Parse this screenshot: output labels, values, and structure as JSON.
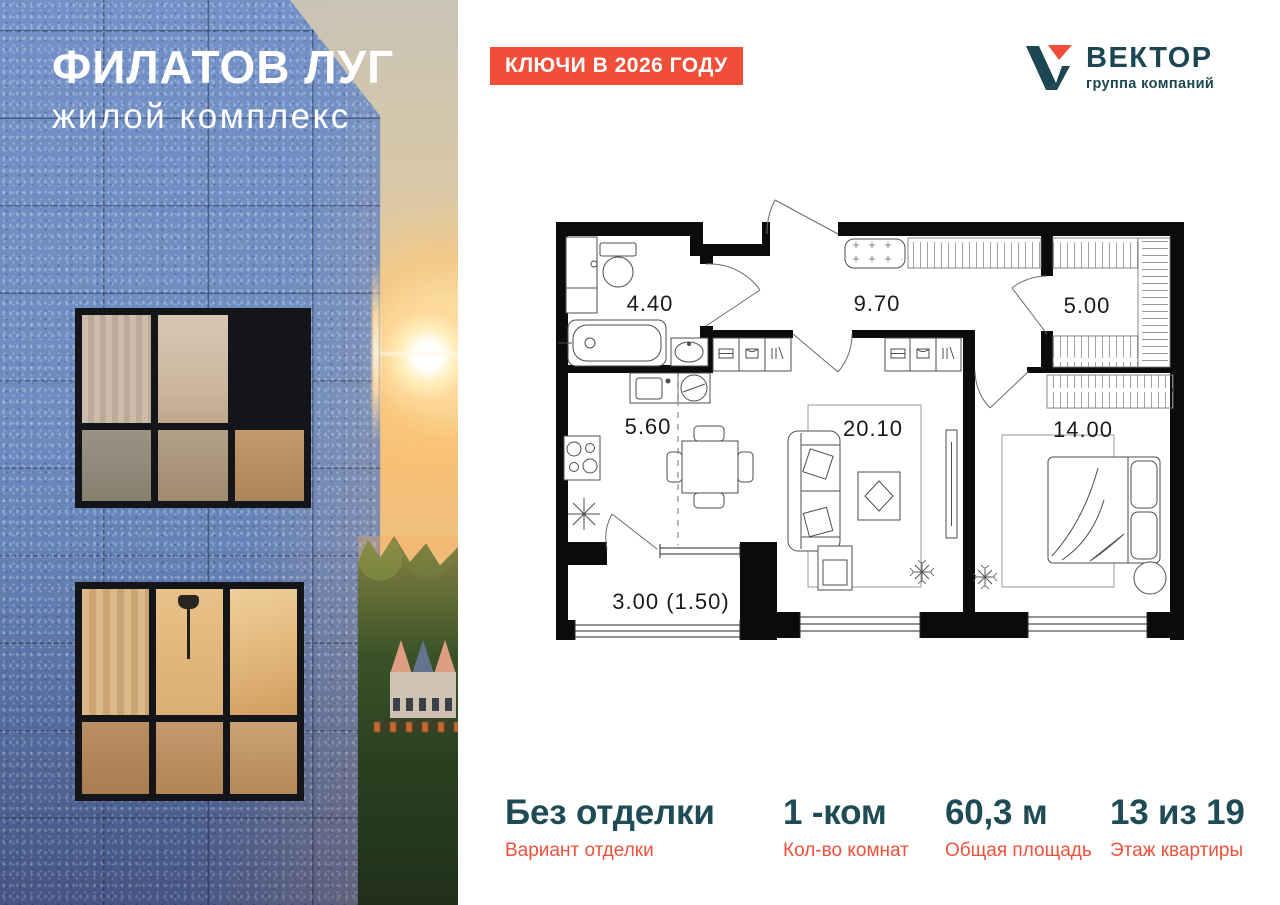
{
  "photo": {
    "title": "ФИЛАТОВ ЛУГ",
    "subtitle": "жилой комплекс"
  },
  "badge": {
    "text": "КЛЮЧИ В 2026 ГОДУ",
    "bg": "#F04E38"
  },
  "logo": {
    "name": "ВЕКТОР",
    "tagline": "группа компаний",
    "color": "#1C4752",
    "accent": "#F04E38"
  },
  "plan": {
    "rooms": [
      {
        "name": "bathroom",
        "label": "4.40"
      },
      {
        "name": "hallway",
        "label": "9.70"
      },
      {
        "name": "wardrobe",
        "label": "5.00"
      },
      {
        "name": "kitchen",
        "label": "5.60"
      },
      {
        "name": "living-room",
        "label": "20.10"
      },
      {
        "name": "bedroom",
        "label": "14.00"
      },
      {
        "name": "balcony",
        "label": "3.00 (1.50)"
      }
    ]
  },
  "stats": {
    "items": [
      {
        "value": "Без отделки",
        "label": "Вариант отделки"
      },
      {
        "value": "1 -ком",
        "label": "Кол-во комнат"
      },
      {
        "value": "60,3 м",
        "label": "Общая площадь"
      },
      {
        "value": "13 из 19",
        "label": "Этаж квартиры"
      }
    ]
  },
  "colors": {
    "accent": "#F04E38",
    "teal": "#1F4B55",
    "plan_line": "#1b1b1b"
  }
}
